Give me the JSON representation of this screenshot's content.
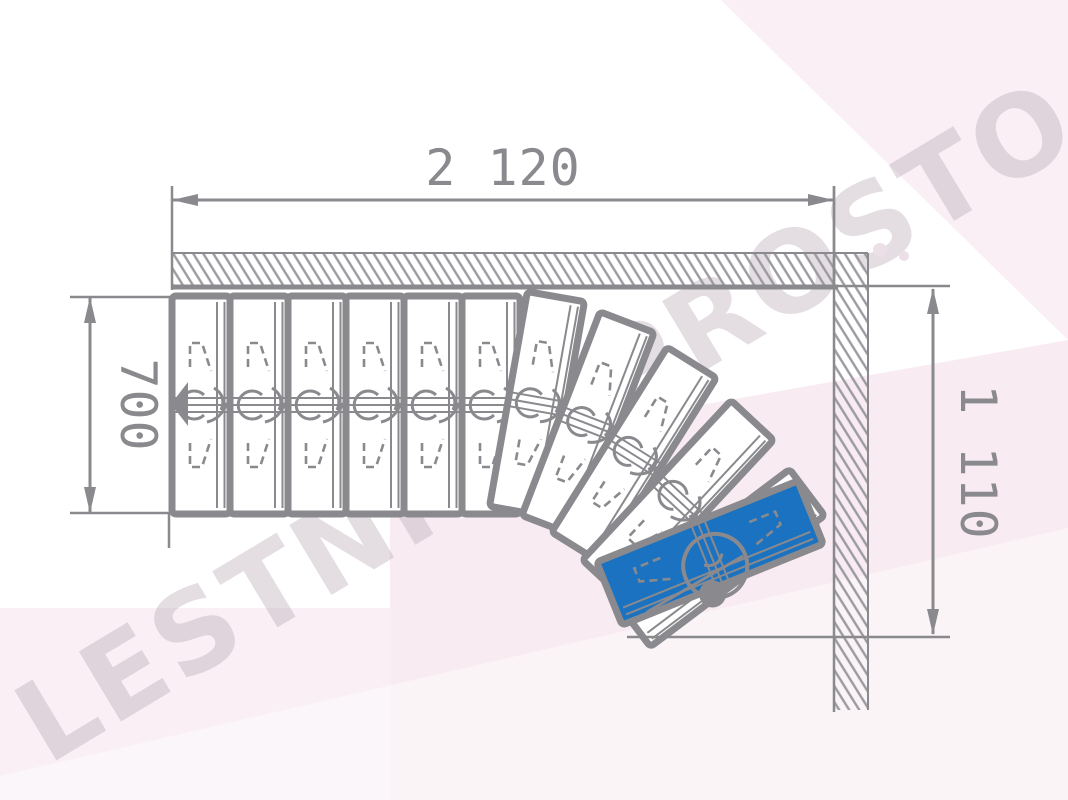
{
  "watermark": {
    "text": "LESTNICY-PROSTO.RU"
  },
  "dimensions": {
    "top": {
      "label": "2 120",
      "orientation": "horizontal"
    },
    "left": {
      "label": "700",
      "orientation": "vertical"
    },
    "right": {
      "label": "1 110",
      "orientation": "vertical"
    }
  },
  "stairs": {
    "straight_steps": 6,
    "winder_steps": 6,
    "total_steps": 12,
    "highlighted_step": "last winder step (blue)"
  },
  "colors": {
    "line": "#8a8a8e",
    "highlight_blue": "#1b72c0",
    "hatch": "#9a9aa0",
    "background_pink": "#f8ecf2",
    "watermark": "rgba(183,168,180,0.38)"
  }
}
